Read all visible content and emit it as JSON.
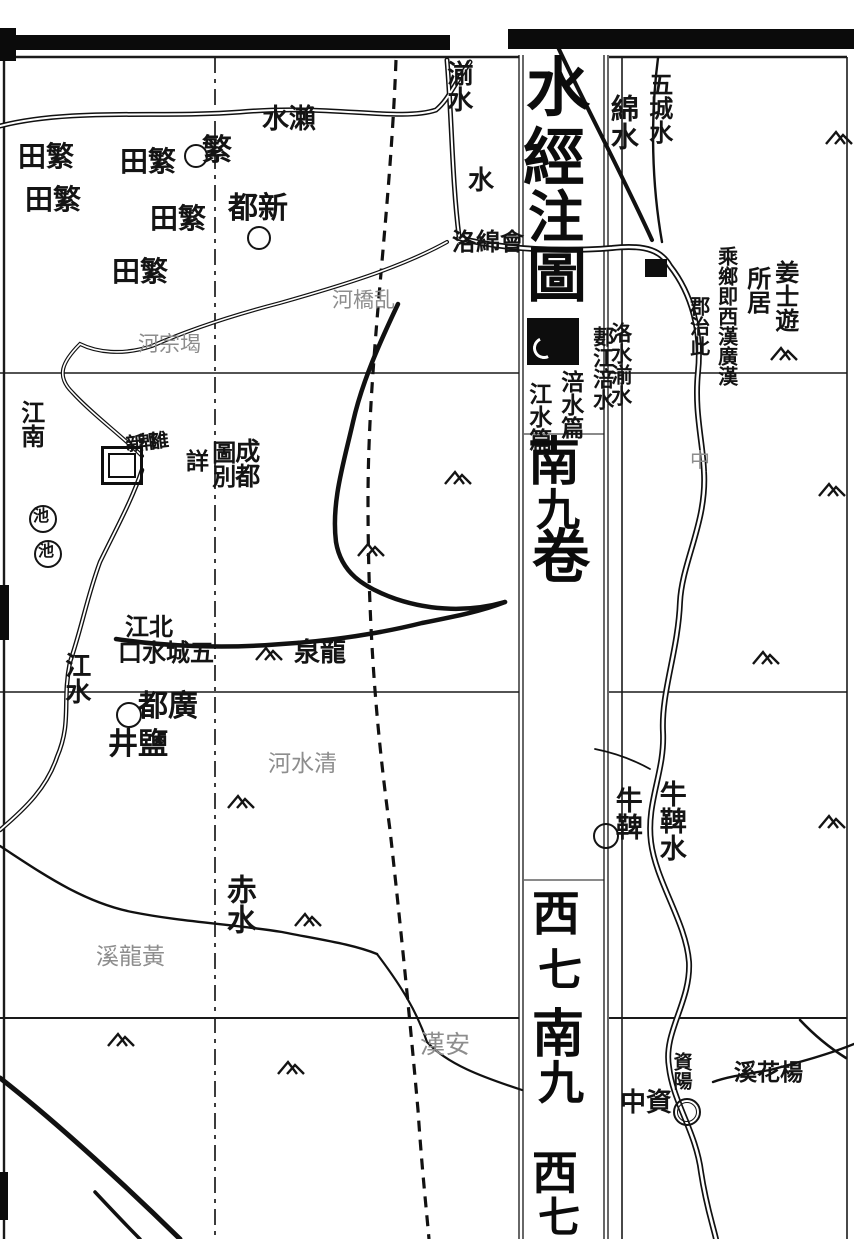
{
  "map": {
    "description": "Woodblock-printed historical Chinese map sheet (Shui Jing Zhu atlas style), Chengdu / Guanghan region",
    "ink_color": "#141414",
    "faint_color": "#8d8d8d",
    "paper_color": "#ffffff",
    "fold_strip": {
      "atlas_title": "水經注圖",
      "chapter_columns": [
        "涪水篇",
        "江水篇"
      ],
      "sheet_index_upper": "南九卷",
      "sheet_index_lower": "西七南九 西七"
    },
    "labels": [
      {
        "text": "水瀨",
        "x": 262,
        "y": 106,
        "dir": "h",
        "size": 27,
        "kind": "solid",
        "name": "river-label-laishui"
      },
      {
        "text": "繁",
        "x": 202,
        "y": 136,
        "dir": "h",
        "size": 30,
        "kind": "solid",
        "name": "county-label-fan"
      },
      {
        "text": "田繁",
        "x": 18,
        "y": 143,
        "dir": "h",
        "size": 28,
        "kind": "solid",
        "name": "fantian-label"
      },
      {
        "text": "田繁",
        "x": 120,
        "y": 148,
        "dir": "h",
        "size": 28,
        "kind": "solid",
        "name": "fantian-label"
      },
      {
        "text": "田繁",
        "x": 25,
        "y": 186,
        "dir": "h",
        "size": 28,
        "kind": "solid",
        "name": "fantian-label"
      },
      {
        "text": "田繁",
        "x": 150,
        "y": 205,
        "dir": "h",
        "size": 28,
        "kind": "solid",
        "name": "fantian-label"
      },
      {
        "text": "田繁",
        "x": 112,
        "y": 258,
        "dir": "h",
        "size": 28,
        "kind": "solid",
        "name": "fantian-label"
      },
      {
        "text": "都新",
        "x": 228,
        "y": 194,
        "dir": "h",
        "size": 30,
        "kind": "solid",
        "name": "county-label-xindu"
      },
      {
        "text": "湔水",
        "x": 444,
        "y": 60,
        "dir": "v",
        "size": 26,
        "kind": "solid",
        "name": "river-label-jianshui"
      },
      {
        "text": "水",
        "x": 468,
        "y": 168,
        "dir": "h",
        "size": 26,
        "kind": "solid",
        "name": "river-label-shui"
      },
      {
        "text": "綿水",
        "x": 608,
        "y": 94,
        "dir": "v",
        "size": 28,
        "kind": "solid",
        "name": "river-label-mianshui"
      },
      {
        "text": "五城水",
        "x": 646,
        "y": 72,
        "dir": "v",
        "size": 24,
        "kind": "solid",
        "name": "river-label-wuchengshui"
      },
      {
        "text": "河橋乱",
        "x": 332,
        "y": 290,
        "dir": "h",
        "size": 21,
        "kind": "faint",
        "name": "bridge-label"
      },
      {
        "text": "河宗堨",
        "x": 138,
        "y": 334,
        "dir": "h",
        "size": 21,
        "kind": "faint",
        "name": "weir-label"
      },
      {
        "text": "洛綿會",
        "x": 452,
        "y": 230,
        "dir": "h",
        "size": 24,
        "kind": "solid",
        "name": "confluence-label"
      },
      {
        "text": "洛水湔水",
        "x": 610,
        "y": 322,
        "dir": "v",
        "size": 21,
        "kind": "solid",
        "name": "river-label-luo-jian"
      },
      {
        "text": "郪江涪水",
        "x": 592,
        "y": 326,
        "dir": "v",
        "size": 21,
        "kind": "solid",
        "name": "river-label-qi-fu"
      },
      {
        "text": "乘鄉即西漢廣漢",
        "x": 716,
        "y": 246,
        "dir": "v",
        "size": 20,
        "kind": "solid",
        "name": "note-guanghan-seat"
      },
      {
        "text": "郡治此",
        "x": 688,
        "y": 296,
        "dir": "v",
        "size": 20,
        "kind": "solid",
        "name": "note-guanghan-seat-2"
      },
      {
        "text": "姜士遊",
        "x": 772,
        "y": 260,
        "dir": "v",
        "size": 24,
        "kind": "solid",
        "name": "note-jiangshiyou"
      },
      {
        "text": "所居",
        "x": 744,
        "y": 266,
        "dir": "v",
        "size": 24,
        "kind": "solid",
        "name": "note-jiangshiyou-2"
      },
      {
        "text": "江南",
        "x": 18,
        "y": 400,
        "dir": "v",
        "size": 24,
        "kind": "solid",
        "name": "river-label-southbranch"
      },
      {
        "text": "詳",
        "x": 186,
        "y": 450,
        "dir": "h",
        "size": 23,
        "kind": "solid",
        "name": "note-chengdu-map"
      },
      {
        "text": "圖別",
        "x": 209,
        "y": 440,
        "dir": "v",
        "size": 24,
        "kind": "solid",
        "name": "note-chengdu-map-2"
      },
      {
        "text": "成都",
        "x": 233,
        "y": 438,
        "dir": "v",
        "size": 25,
        "kind": "solid",
        "name": "city-label-chengdu"
      },
      {
        "text": "新郫雒",
        "x": 126,
        "y": 434,
        "dir": "h",
        "size": 19,
        "kind": "cluster",
        "name": "dense-place-cluster"
      },
      {
        "text": "池",
        "x": 33,
        "y": 508,
        "dir": "h",
        "size": 16,
        "kind": "solid",
        "name": "pond-label"
      },
      {
        "text": "池",
        "x": 38,
        "y": 543,
        "dir": "h",
        "size": 16,
        "kind": "solid",
        "name": "pond-label"
      },
      {
        "text": "中",
        "x": 690,
        "y": 450,
        "dir": "h",
        "size": 20,
        "kind": "faint",
        "name": "faint-label-zhong"
      },
      {
        "text": "江北",
        "x": 125,
        "y": 615,
        "dir": "h",
        "size": 24,
        "kind": "solid",
        "name": "river-label-northbranch"
      },
      {
        "text": "口水城五",
        "x": 118,
        "y": 641,
        "dir": "h",
        "size": 24,
        "kind": "solid",
        "name": "river-label-wucheng-mouth"
      },
      {
        "text": "泉龍",
        "x": 294,
        "y": 640,
        "dir": "h",
        "size": 26,
        "kind": "solid",
        "name": "place-label-longquan"
      },
      {
        "text": "江水",
        "x": 62,
        "y": 652,
        "dir": "v",
        "size": 26,
        "kind": "solid",
        "name": "river-label-jiangshui"
      },
      {
        "text": "都廣",
        "x": 138,
        "y": 692,
        "dir": "h",
        "size": 30,
        "kind": "solid",
        "name": "county-label-guangdu"
      },
      {
        "text": "井鹽",
        "x": 108,
        "y": 730,
        "dir": "h",
        "size": 30,
        "kind": "solid",
        "name": "label-salt-wells"
      },
      {
        "text": "河水清",
        "x": 268,
        "y": 753,
        "dir": "h",
        "size": 23,
        "kind": "faint",
        "name": "river-label-qingshui"
      },
      {
        "text": "牛鞞",
        "x": 612,
        "y": 786,
        "dir": "v",
        "size": 27,
        "kind": "solid",
        "name": "county-label-niubing"
      },
      {
        "text": "牛鞞水",
        "x": 656,
        "y": 780,
        "dir": "v",
        "size": 27,
        "kind": "solid",
        "name": "river-label-niubingshui"
      },
      {
        "text": "赤水",
        "x": 222,
        "y": 874,
        "dir": "v",
        "size": 30,
        "kind": "solid",
        "name": "river-label-chishui"
      },
      {
        "text": "溪龍黃",
        "x": 96,
        "y": 946,
        "dir": "h",
        "size": 23,
        "kind": "faint",
        "name": "stream-label-huanglongxi"
      },
      {
        "text": "漢安",
        "x": 420,
        "y": 1032,
        "dir": "h",
        "size": 25,
        "kind": "faint",
        "name": "faint-label-hanan"
      },
      {
        "text": "中資",
        "x": 620,
        "y": 1090,
        "dir": "h",
        "size": 26,
        "kind": "solid",
        "name": "county-label-zizhong"
      },
      {
        "text": "資陽",
        "x": 671,
        "y": 1052,
        "dir": "v",
        "size": 19,
        "kind": "solid",
        "name": "city-label-ziyang"
      },
      {
        "text": "溪花楊",
        "x": 734,
        "y": 1061,
        "dir": "h",
        "size": 23,
        "kind": "solid",
        "name": "stream-label-yanghuaxi"
      },
      {
        "text": "水",
        "x": 526,
        "y": 56,
        "dir": "h",
        "size": 64,
        "kind": "title",
        "name": "fold-title-char"
      },
      {
        "text": "經",
        "x": 523,
        "y": 126,
        "dir": "h",
        "size": 62,
        "kind": "title",
        "name": "fold-title-char"
      },
      {
        "text": "注",
        "x": 528,
        "y": 190,
        "dir": "h",
        "size": 56,
        "kind": "title",
        "name": "fold-title-char"
      },
      {
        "text": "圖",
        "x": 527,
        "y": 246,
        "dir": "h",
        "size": 60,
        "kind": "title",
        "name": "fold-title-char"
      },
      {
        "text": "涪水篇",
        "x": 558,
        "y": 370,
        "dir": "v",
        "size": 23,
        "kind": "solid",
        "name": "fold-chapter-fushui"
      },
      {
        "text": "江水篇",
        "x": 526,
        "y": 382,
        "dir": "v",
        "size": 23,
        "kind": "solid",
        "name": "fold-chapter-jiangshui"
      },
      {
        "text": "南",
        "x": 528,
        "y": 436,
        "dir": "h",
        "size": 52,
        "kind": "title",
        "name": "fold-index-char"
      },
      {
        "text": "九",
        "x": 536,
        "y": 488,
        "dir": "h",
        "size": 44,
        "kind": "title",
        "name": "fold-index-char"
      },
      {
        "text": "卷",
        "x": 532,
        "y": 528,
        "dir": "h",
        "size": 58,
        "kind": "title",
        "name": "fold-index-char"
      },
      {
        "text": "西",
        "x": 532,
        "y": 890,
        "dir": "h",
        "size": 48,
        "kind": "title",
        "name": "fold-index-char"
      },
      {
        "text": "七",
        "x": 538,
        "y": 948,
        "dir": "h",
        "size": 44,
        "kind": "title",
        "name": "fold-index-char"
      },
      {
        "text": "南",
        "x": 532,
        "y": 1008,
        "dir": "h",
        "size": 52,
        "kind": "title",
        "name": "fold-index-char"
      },
      {
        "text": "九",
        "x": 538,
        "y": 1060,
        "dir": "h",
        "size": 46,
        "kind": "title",
        "name": "fold-index-char"
      },
      {
        "text": "西",
        "x": 532,
        "y": 1150,
        "dir": "h",
        "size": 46,
        "kind": "title",
        "name": "fold-index-char"
      },
      {
        "text": "七",
        "x": 538,
        "y": 1196,
        "dir": "h",
        "size": 42,
        "kind": "title",
        "name": "fold-index-char"
      }
    ],
    "mountains": [
      [
        443,
        466
      ],
      [
        356,
        538
      ],
      [
        254,
        642
      ],
      [
        226,
        790
      ],
      [
        293,
        908
      ],
      [
        106,
        1028
      ],
      [
        276,
        1056
      ],
      [
        824,
        126
      ],
      [
        769,
        342
      ],
      [
        817,
        478
      ],
      [
        751,
        646
      ],
      [
        817,
        810
      ]
    ],
    "circles": [
      {
        "x": 194,
        "y": 154,
        "r": 10
      },
      {
        "x": 257,
        "y": 236,
        "r": 10
      },
      {
        "x": 41,
        "y": 517,
        "r": 12
      },
      {
        "x": 46,
        "y": 552,
        "r": 12
      },
      {
        "x": 127,
        "y": 713,
        "r": 11
      },
      {
        "x": 604,
        "y": 834,
        "r": 11
      },
      {
        "x": 685,
        "y": 1110,
        "r": 12,
        "double": true
      }
    ],
    "black_squares": [
      {
        "x": 645,
        "y": 259,
        "w": 22,
        "h": 18
      }
    ],
    "city_square": {
      "x": 101,
      "y": 446,
      "w": 36,
      "h": 33
    },
    "ink_box": {
      "x": 527,
      "y": 318,
      "w": 52,
      "h": 47
    },
    "scan_bars": [
      {
        "x": 15,
        "y": 35,
        "w": 435,
        "h": 15
      },
      {
        "x": 508,
        "y": 29,
        "w": 346,
        "h": 20
      },
      {
        "x": 0,
        "y": 28,
        "w": 16,
        "h": 33
      },
      {
        "x": 0,
        "y": 585,
        "w": 9,
        "h": 55
      },
      {
        "x": 0,
        "y": 1172,
        "w": 8,
        "h": 48
      }
    ]
  }
}
